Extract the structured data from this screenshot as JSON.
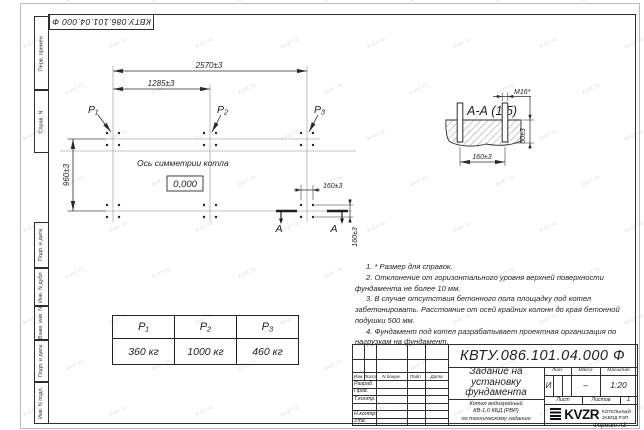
{
  "sheet": {
    "stamp": "КВТУ.086.101.04.000  Ф",
    "format": "Формат А3",
    "watermark": "kvzr.ru",
    "margin_labels": [
      "Перв. примен.",
      "Справ. N",
      "Подп. и дата",
      "Инв. N дубл.",
      "Взам. инв. N",
      "Подп. и дата",
      "Инв. N подл."
    ]
  },
  "plan": {
    "dim_total": "2570±3",
    "dim_half": "1285±3",
    "dim_depth": "960±3",
    "dim_bolt_x": "160±3",
    "dim_bolt_y": "160±3",
    "axis_label": "Ось симметрии котла",
    "level_mark": "0,000",
    "p1": "P₁",
    "p2": "P₂",
    "p3": "P₃",
    "section_letter_left": "А",
    "section_letter_right": "А"
  },
  "section": {
    "title": "А-А  (1:5)",
    "thread": "M16*",
    "dim_height": "50±3",
    "dim_width": "160±3"
  },
  "notes": {
    "lines": [
      "1.  * Размер для справок.",
      "2.  Отклонение от горизонтального уровня верхней поверхности фундамента не более 10 мм.",
      "3.  В случае отсутствия бетонного пола площадку под котел забетонировать. Расстояние от осей крайних колонн до края бетонной подушки 500 мм.",
      "4.  Фундамент под котел разрабатывает проектная организация по нагрузкам на фундамент."
    ]
  },
  "load_table": {
    "headers": [
      "P₁",
      "P₂",
      "P₃"
    ],
    "values": [
      "360 кг",
      "1000 кг",
      "460 кг"
    ]
  },
  "title_block": {
    "designation": "КВТУ.086.101.04.000  Ф",
    "doc_title": "Задание на\nустановку\nфундамента",
    "object": "Котел водогрейный\nКВ-1,0 КБД (РВР)\nпо техническому заданию",
    "rev_headers": [
      "Изм.",
      "Лист",
      "N докум.",
      "Подп.",
      "Дата"
    ],
    "sig_rows": [
      "Разраб.",
      "Пров.",
      "Т.контр.",
      "",
      "Н.контр.",
      "Утв."
    ],
    "lit_header": "Лит.",
    "mass_header": "Масса",
    "scale_header": "Масштаб",
    "lit": "И",
    "mass": "–",
    "scale": "1:20",
    "sheet_label": "Лист",
    "sheets_label": "Листов",
    "sheets_value": "1",
    "logo": "KVZR",
    "company": "КОТЕЛЬНЫЙ\nЗАВОД РЭП"
  }
}
